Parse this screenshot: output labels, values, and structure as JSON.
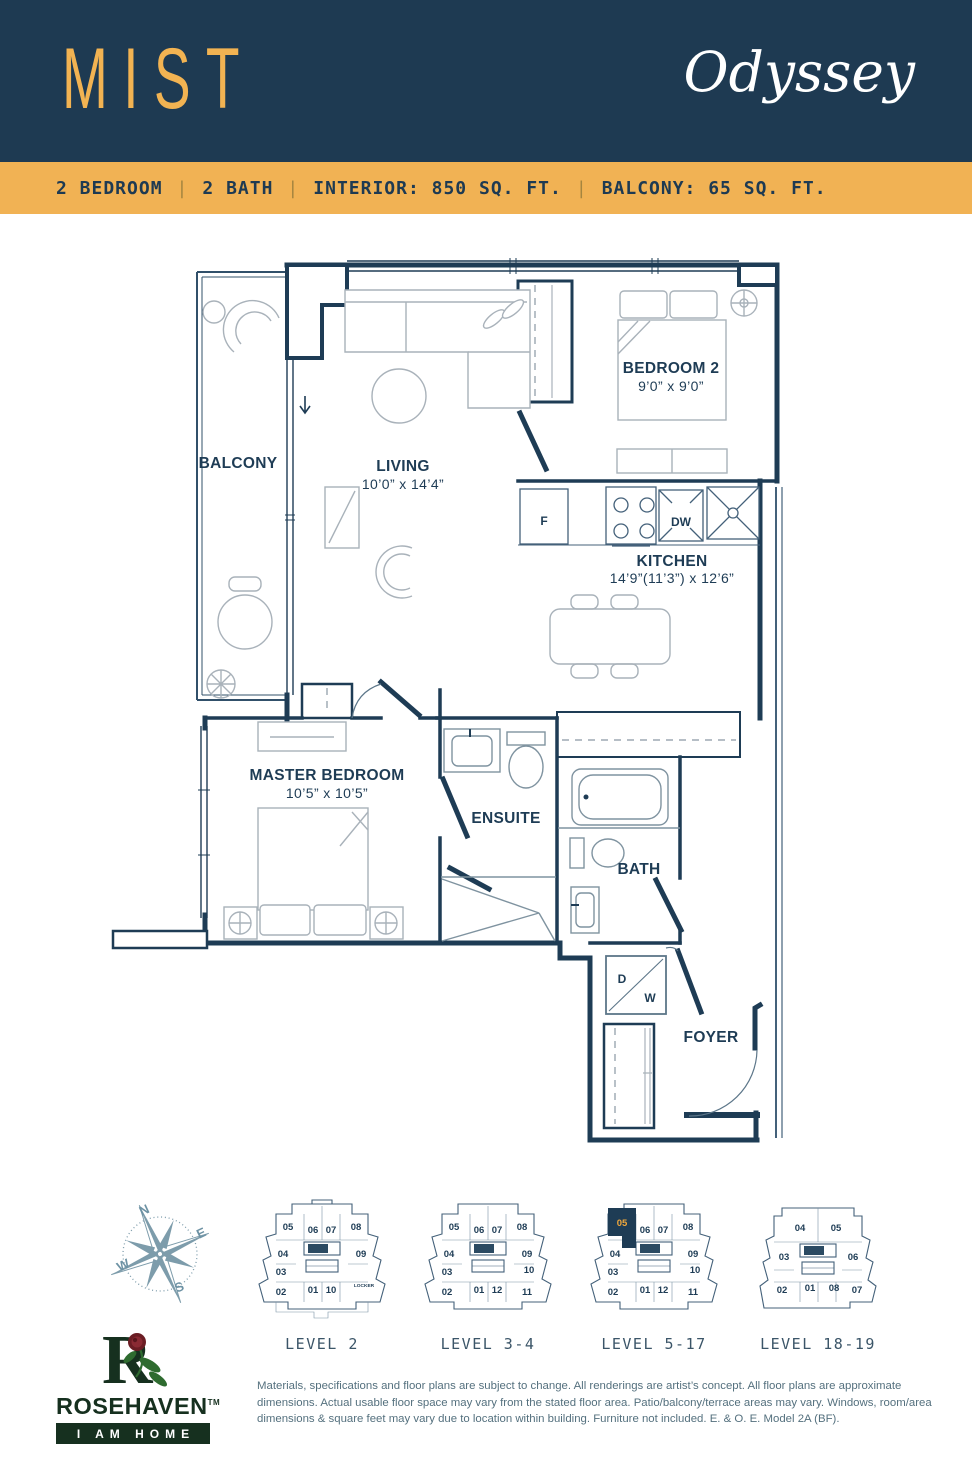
{
  "header": {
    "unit_name": "MIST",
    "brand": "Odyssey"
  },
  "specs": {
    "bedrooms": "2 BEDROOM",
    "baths": "2 BATH",
    "interior": "INTERIOR: 850 SQ. FT.",
    "balcony": "BALCONY: 65 SQ. FT.",
    "divider": "|"
  },
  "floorplan": {
    "rooms": {
      "balcony": {
        "name": "BALCONY"
      },
      "living": {
        "name": "LIVING",
        "dims": "10’0” x 14’4”"
      },
      "bedroom2": {
        "name": "BEDROOM 2",
        "dims": "9’0” x 9’0”"
      },
      "kitchen": {
        "name": "KITCHEN",
        "dims": "14’9”(11’3”) x 12’6”"
      },
      "master": {
        "name": "MASTER BEDROOM",
        "dims": "10’5” x 10’5”"
      },
      "ensuite": {
        "name": "ENSUITE"
      },
      "bath": {
        "name": "BATH"
      },
      "foyer": {
        "name": "FOYER"
      }
    },
    "appliances": {
      "fridge": "F",
      "dishwasher": "DW",
      "dryer": "D",
      "washer": "W"
    }
  },
  "compass": {
    "n": "N",
    "e": "E",
    "s": "S",
    "w": "W"
  },
  "keyplans": [
    {
      "label": "LEVEL 2",
      "highlighted_unit": "",
      "units": [
        "05",
        "06",
        "07",
        "08",
        "04",
        "09",
        "03",
        "02",
        "01",
        "10",
        "LOCKER"
      ]
    },
    {
      "label": "LEVEL 3-4",
      "highlighted_unit": "",
      "units": [
        "05",
        "06",
        "07",
        "08",
        "04",
        "09",
        "03",
        "10",
        "02",
        "01",
        "12",
        "11"
      ]
    },
    {
      "label": "LEVEL 5-17",
      "highlighted_unit": "05",
      "units": [
        "05",
        "06",
        "07",
        "08",
        "04",
        "09",
        "03",
        "10",
        "02",
        "01",
        "12",
        "11"
      ]
    },
    {
      "label": "LEVEL 18-19",
      "highlighted_unit": "",
      "units": [
        "04",
        "05",
        "03",
        "06",
        "02",
        "01",
        "08",
        "07"
      ]
    }
  ],
  "logo": {
    "name": "ROSEHAVEN",
    "tm": "TM",
    "tagline": "I AM HOME"
  },
  "disclaimer": "Materials, specifications and floor plans are subject to change. All renderings are artist’s concept. All floor plans are approximate dimensions. Actual usable floor space may vary from the stated floor area. Patio/balcony/terrace areas may vary. Windows, room/area dimensions & square feet may vary due to location within building. Furniture not included. E. & O. E. Model 2A (BF).",
  "colors": {
    "navy": "#1e3a52",
    "gold": "#f1b254",
    "wall": "#1e3c55",
    "furniture": "#a9b2ba",
    "compass": "#7d9cab",
    "logo_green": "#16301f"
  }
}
